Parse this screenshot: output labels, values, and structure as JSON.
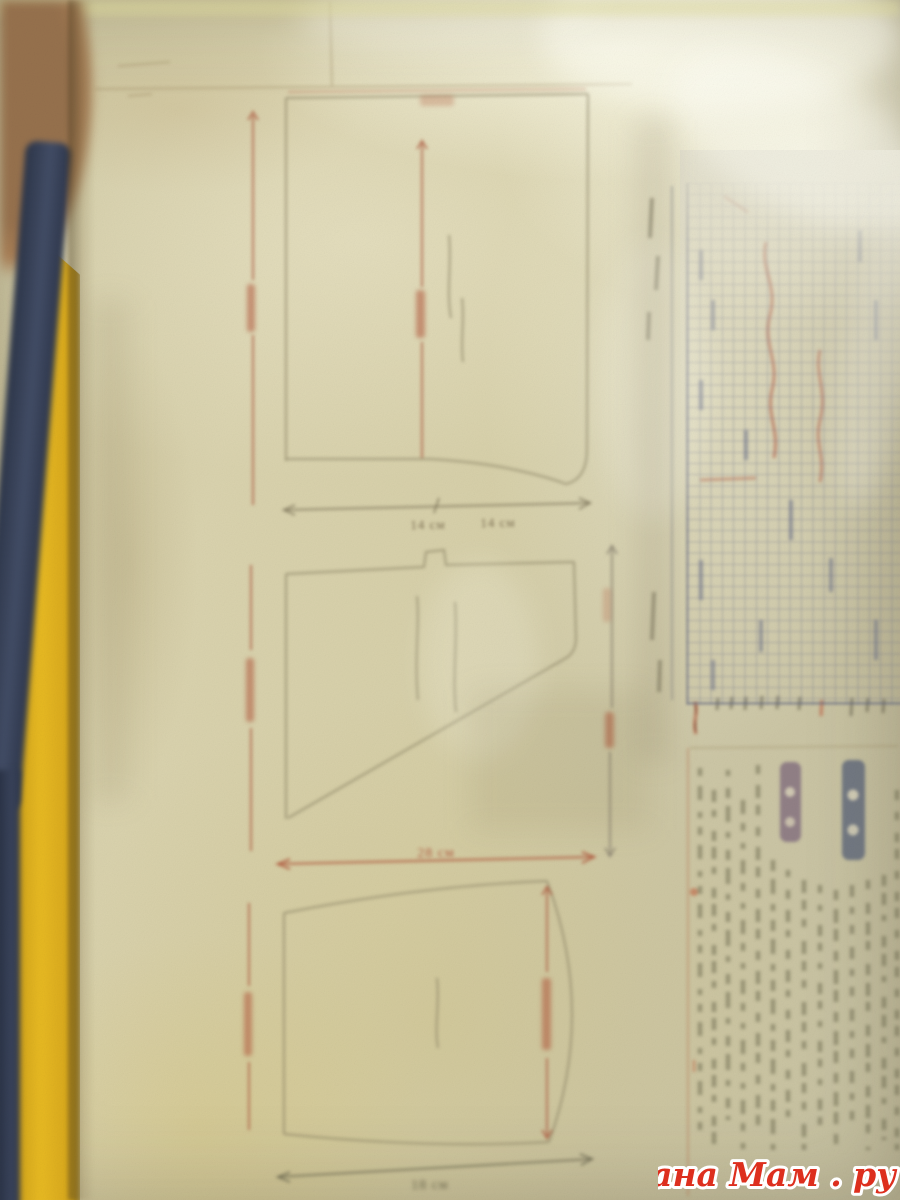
{
  "watermark": {
    "text": "Страна Мам . ру"
  },
  "labels": {
    "top_piece_width_left": "14 см",
    "top_piece_width_right": "14 см",
    "middle_piece_width": "28 см",
    "bottom_piece_width": "18 см"
  },
  "colors": {
    "paper": "#d7d0a9",
    "dimension_red": "#ad5a40",
    "outline_gray": "#8e8668",
    "grid_blue": "#686e8c",
    "chart_symbol_red": "#b4604a",
    "watermark_red": "#dd2f1e",
    "book_cover_yellow": "#e8ba22",
    "cord_navy": "#39425a",
    "corner_brown": "#96714d"
  }
}
